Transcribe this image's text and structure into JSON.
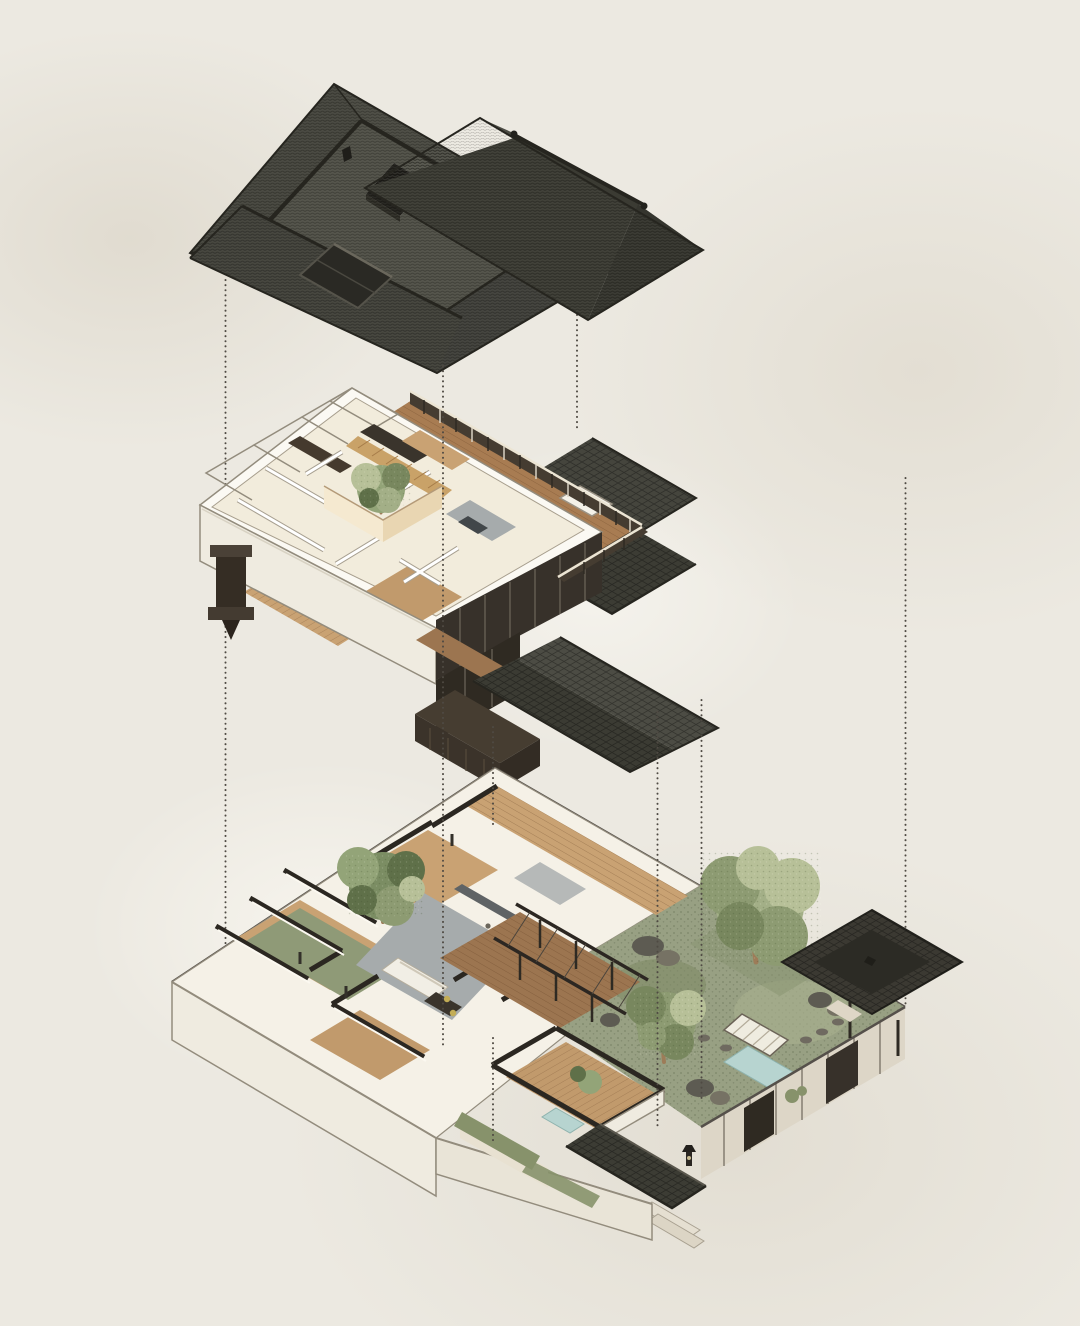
{
  "meta": {
    "title": "Exploded axonometric diagram of a Chinese courtyard house",
    "medium": "architectural illustration on textured paper, no visible text",
    "projection": "exploded isometric, three stacked levels joined by dotted guide lines"
  },
  "palette": {
    "paper": "#ece9e1",
    "guide": "#4f4a43",
    "roof-slope-1": "#4a4a42",
    "roof-slope-2": "#40403a",
    "roof-slope-3": "#3c3c34",
    "roof-slope-4": "#45453d",
    "roof-top": "#505047",
    "roof-hole": "#23221d",
    "roof-wing-a": "#4c4c44",
    "roof-wing-b": "#3b3b33",
    "roof-wing-c": "#35352e",
    "roof-annex": "#41413a",
    "roof-ridge": "#26251f",
    "wall-white": "#fbf9f3",
    "wall-face": "#efebe0",
    "wall-outline": "#938c7d",
    "floor-cream": "#f2ecdc",
    "floor-base": "#f5f1e7",
    "wood-floor": "#c9a273",
    "wood-floor-2": "#c19a6c",
    "wood-deck": "#a87c52",
    "wood-deck-2": "#9c7550",
    "gray-floor": "#a6abac",
    "glass-dark": "#37312a",
    "glass-dark-2": "#2f2a22",
    "stone-wall": "#ddd6c7",
    "stone-wall-2": "#e8e1d1",
    "tan-wall-light": "#f5e9d0",
    "tan-wall-shade": "#e9d6b2",
    "slat-wood": "#c9a268",
    "mullion": "#6e675b",
    "poche": "#2b2721",
    "hedge": "#87926b",
    "lawn": "#98a083",
    "water": "#b7d4d0",
    "rock": "#5d5b52",
    "rock-2": "#767264",
    "furniture-dark": "#3a342c",
    "railing-dark": "#453c31",
    "railing-light": "#ece5d4",
    "tree-green-1": "#a3af87",
    "tree-green-2": "#8d9b72",
    "tree-green-3": "#78875e",
    "tree-green-4": "#b7c098",
    "pine-1": "#7b8d63",
    "pine-2": "#93a478",
    "pine-3": "#5f7049",
    "trunk": "#9d7c58"
  },
  "layers": {
    "roof": {
      "label": "Roof level: dark grey tiled hip roofs with central courtyard opening, side wing and recessed skylight"
    },
    "upper_floor": {
      "label": "Upper floor: white cut-away rooms around a tan courtyard lightwell with tree, wood roof terrace with railing, dark glazing and tiled eave roofs, console bracket"
    },
    "ground_floor": {
      "label": "Ground floor: cut-away rooms with dark wall poche, pine courtyard, grey living room, pergola deck, walled garden with trees, rocks, pond, bridge, corner pavilion and entrance gate"
    },
    "guides": {
      "label": "Vertical dotted alignment guide lines between levels",
      "count": 8
    }
  }
}
